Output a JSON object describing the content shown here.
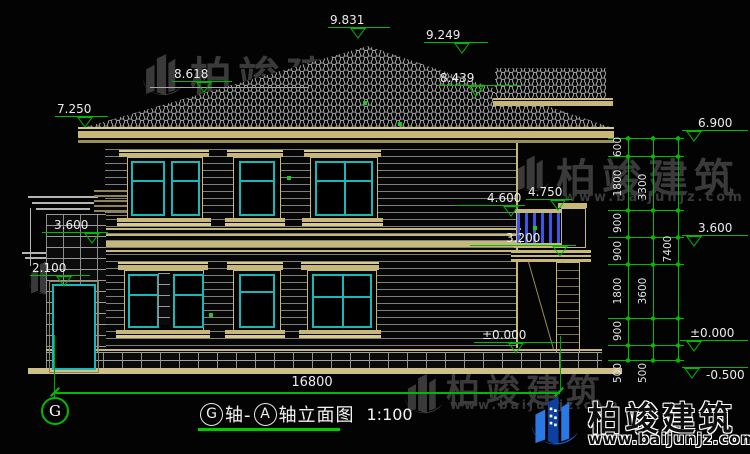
{
  "watermark": {
    "brand": "柏竣建筑",
    "site": "www.baijunjz.com"
  },
  "logo": {
    "brand": "柏竣建筑",
    "site": "www.baijunjz.com"
  },
  "elevations": {
    "main_ridge": "9.831",
    "secondary_ridge": "9.249",
    "left_ridge": "8.618",
    "secondary_eave": "8.439",
    "left_eave": "7.250",
    "porch_roof": "3.600",
    "porch_door": "2.100",
    "balcony_rail": "4.600",
    "balcony_post": "4.750",
    "balcony_slab": "3.200",
    "ground": "±0.000",
    "right_top": "6.900",
    "right_mid": "3.600",
    "right_ground": "±0.000",
    "right_foundation": "-0.500"
  },
  "dimensions": {
    "overall_width": "16800",
    "right_chain_inner": [
      "600",
      "1800",
      "900",
      "900",
      "1800",
      "900",
      "500"
    ],
    "right_chain_middle": [
      "3300",
      "3600",
      "500"
    ],
    "right_chain_outer": [
      "7400"
    ]
  },
  "axes": {
    "left_bubble": "G"
  },
  "title": {
    "bubble_start": "G",
    "segment_1": "轴-",
    "bubble_end": "A",
    "segment_2": "轴立面图",
    "scale": "1:100"
  },
  "colors": {
    "dimension_green": "#00bb00",
    "window_teal": "#19b8b8",
    "trim_tan": "#c8b878",
    "baluster_blue": "#3c55e6",
    "logo_blue": "#1b5fc8"
  }
}
